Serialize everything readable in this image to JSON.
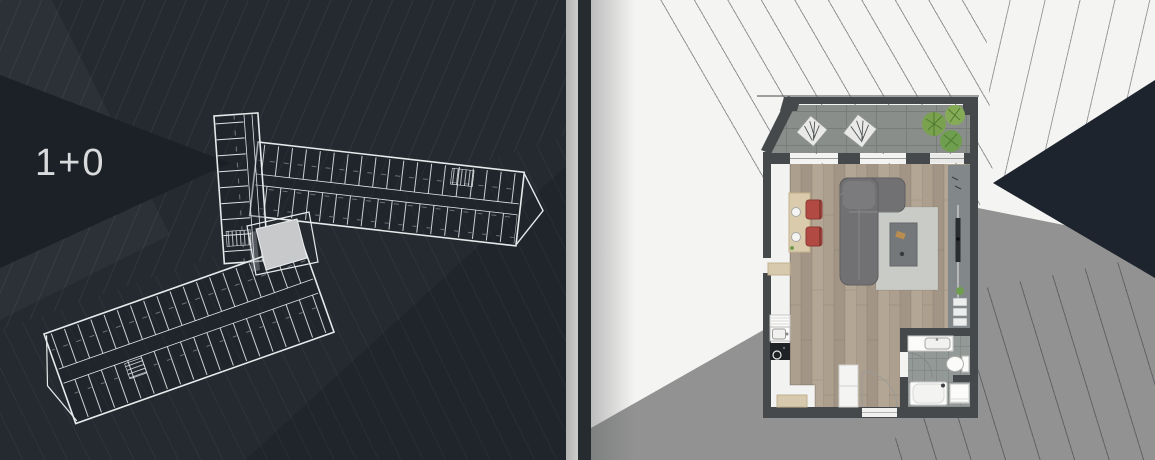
{
  "page": {
    "title": "Residential floor plan presentation"
  },
  "left_panel": {
    "name": "floor-overview",
    "unit_type_label": "1+0",
    "description": "Building storey wireframe with highlighted 1+0 unit"
  },
  "right_panel": {
    "name": "unit-detail-plan",
    "rooms": [
      "terrace",
      "living-room",
      "kitchenette",
      "bathroom",
      "entrance"
    ]
  },
  "colors": {
    "left_background": "#242a30",
    "wedge_dark": "#1b2127",
    "label_text": "#d8dadb",
    "wireframe": "#e7eaeb",
    "highlight_unit": "#c7c9ca",
    "right_background": "#f4f4f2",
    "gray_region": "#919291",
    "navy_triangle": "#1d242d",
    "wall": "#45494c",
    "terrace_tile": "#898e8a",
    "wood_floor": "#aa9d8c",
    "sofa": "#717173",
    "rug": "#c9cbc7",
    "chair_red": "#b04a42",
    "table_wood": "#d9cbab",
    "plant_green": "#7aa24e",
    "tv_band": "#82878a",
    "bath_floor": "#939997"
  }
}
